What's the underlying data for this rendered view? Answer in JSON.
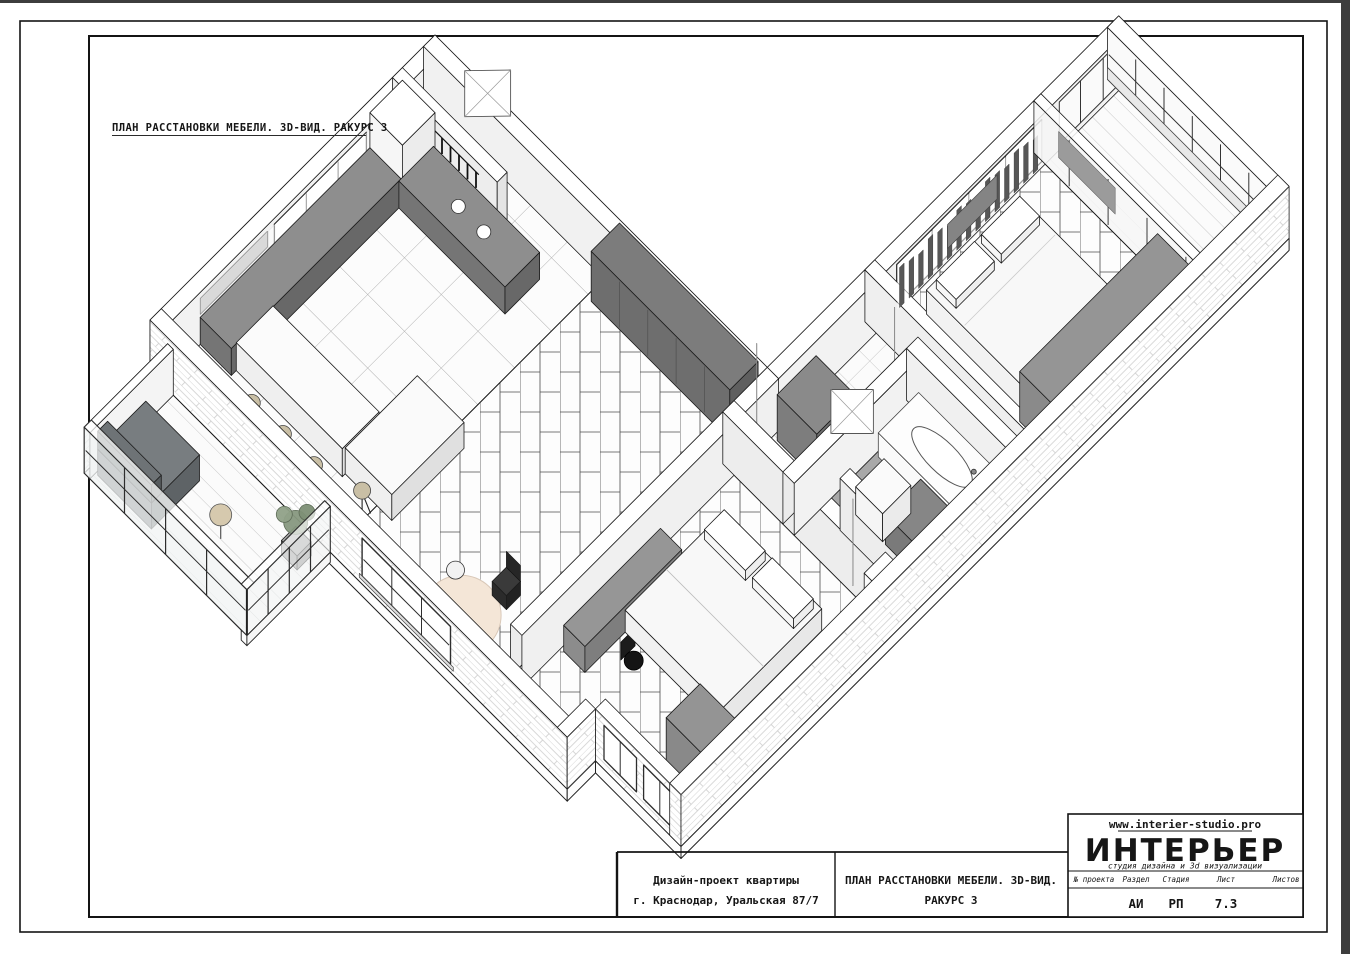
{
  "drawing": {
    "title": "ПЛАН РАССТАНОВКИ МЕБЕЛИ. 3D-ВИД. РАКУРС 3"
  },
  "title_block": {
    "project_line1": "Дизайн-проект квартиры",
    "project_line2": "г. Краснодар, Уральская 87/7",
    "sheet_line1": "ПЛАН РАССТАНОВКИ МЕБЕЛИ. 3D-ВИД.",
    "sheet_line2": "РАКУРС 3",
    "studio": {
      "website": "www.interier-studio.pro",
      "name": "ИНТЕРЬЕР",
      "tagline": "студия дизайна и 3d визуализации"
    },
    "columns": [
      {
        "label": "№ проекта",
        "value": ""
      },
      {
        "label": "Раздел",
        "value": "АИ"
      },
      {
        "label": "Стадия",
        "value": "РП"
      },
      {
        "label": "Лист",
        "value": "7.3"
      },
      {
        "label": "Листов",
        "value": ""
      }
    ]
  },
  "colors": {
    "paper": "#ffffff",
    "frame_line": "#141414",
    "screen_edge": "#3d3d3d",
    "brick_hatch": "#cccccc",
    "furniture_gray": "#8a8a8a",
    "counter_gray": "#6a6a6a",
    "stool_beige": "#c9bfa5",
    "rug_cream": "#f4e6d7",
    "curtain_gray": "#565656",
    "glazing_frame": "#2d2d2d",
    "plant_green": "#87987f"
  }
}
